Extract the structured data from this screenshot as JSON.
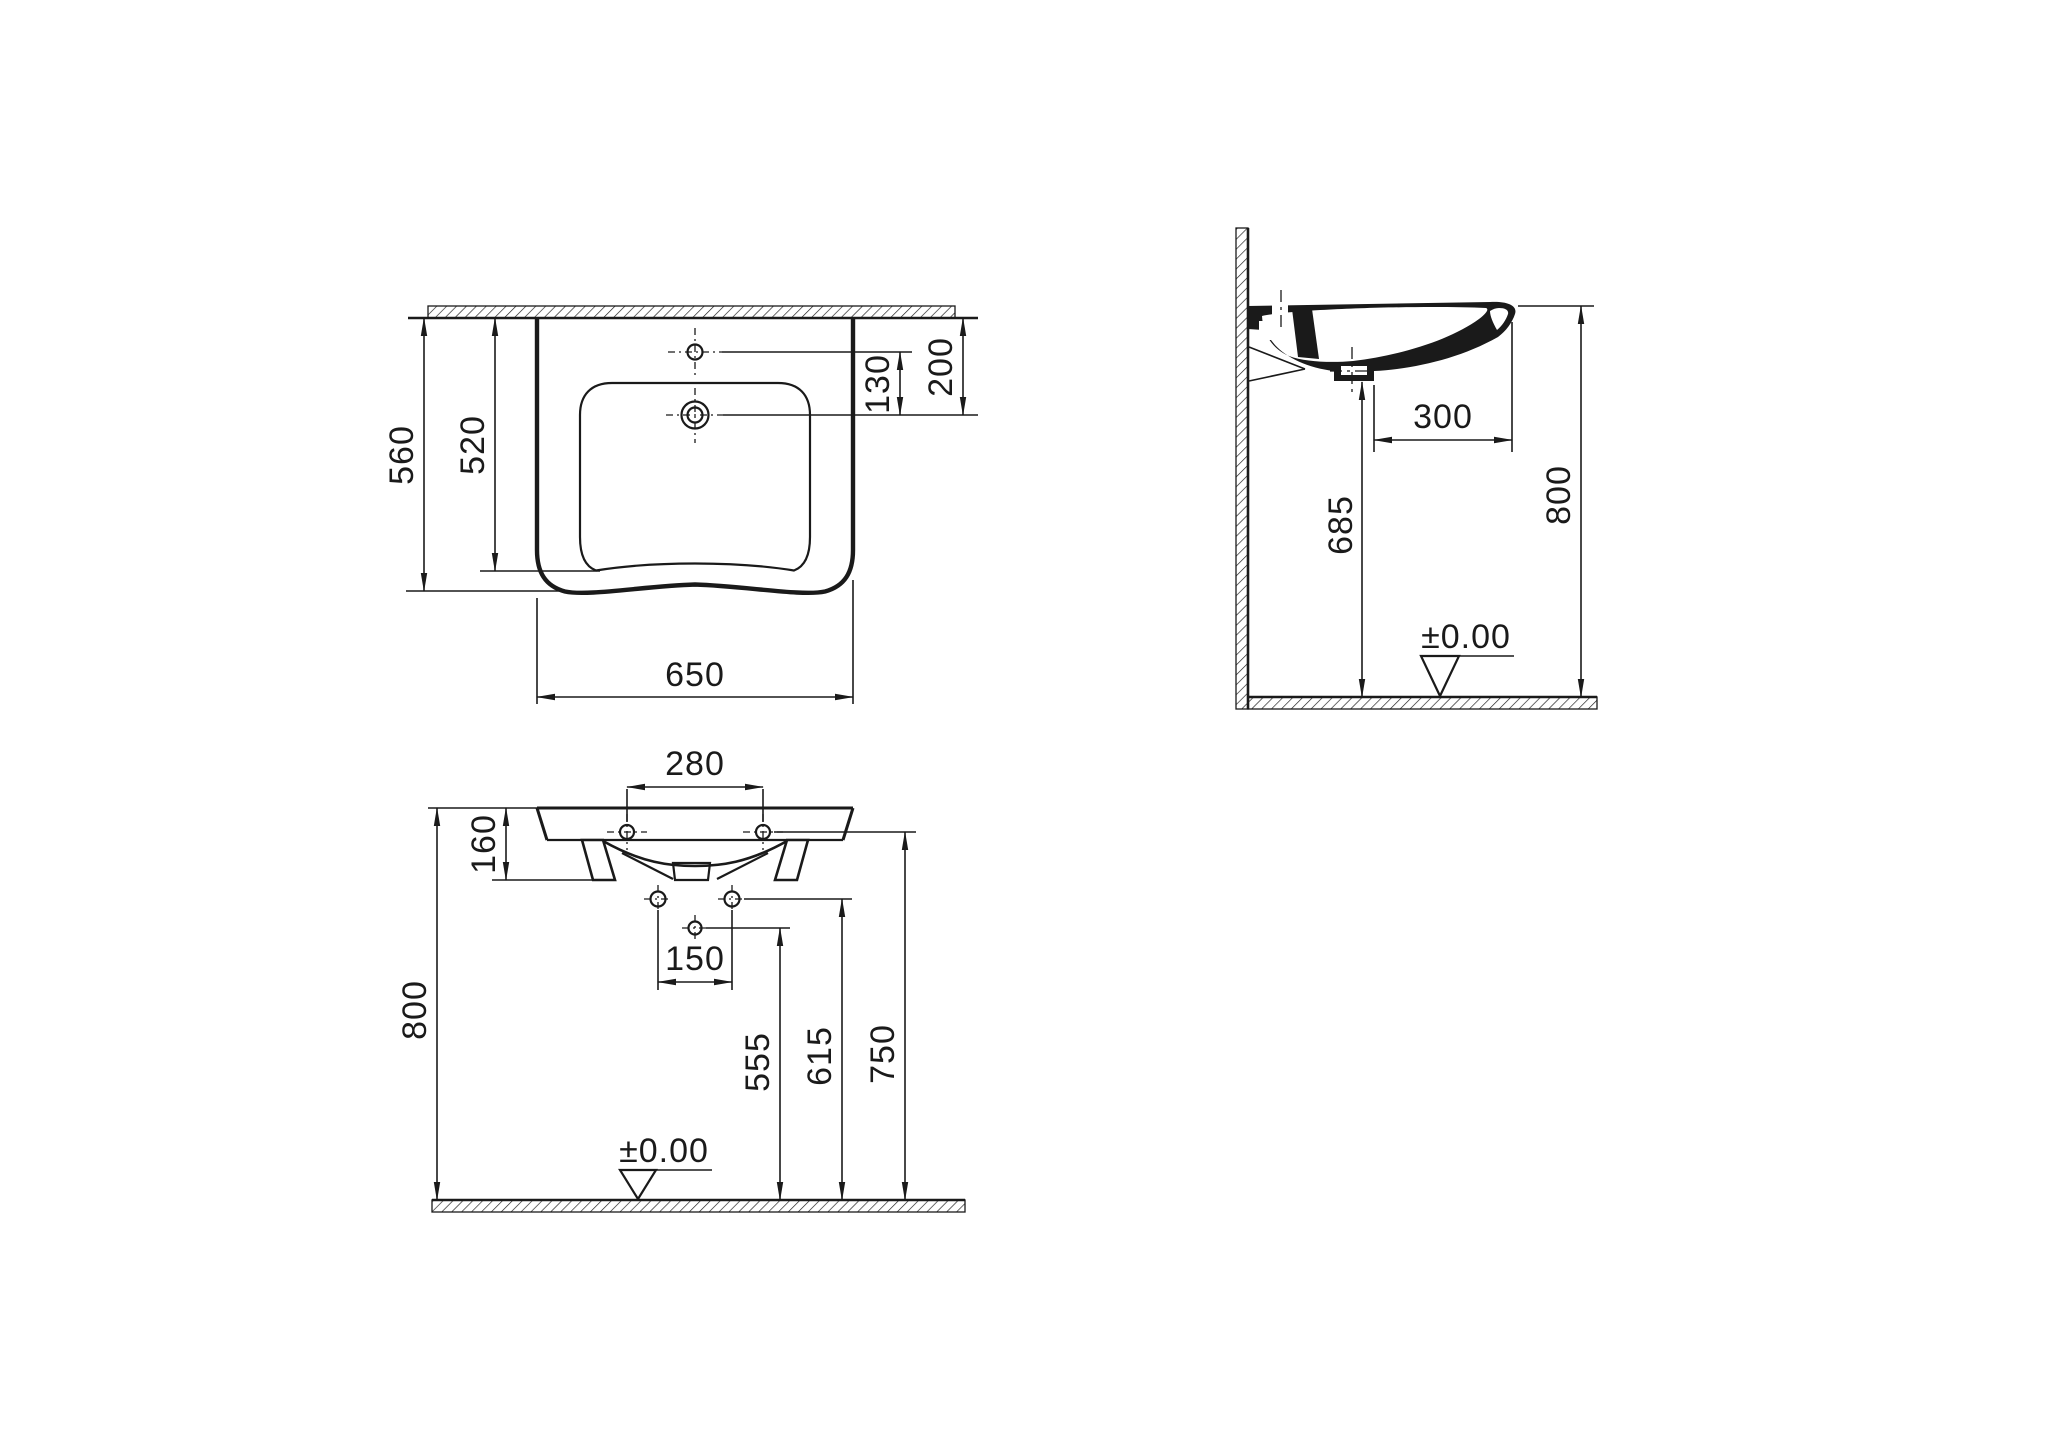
{
  "colors": {
    "ink": "#1a1a1a",
    "paper": "#ffffff"
  },
  "plan_view": {
    "overall_depth": "560",
    "basin_depth": "520",
    "tap_to_drain": "130",
    "wall_to_drain": "200",
    "overall_width": "650"
  },
  "side_view": {
    "drain_to_front": "300",
    "underside_clearance": "685",
    "rim_height": "800",
    "floor_datum": "±0.00"
  },
  "front_view": {
    "tap_hole_spacing": "280",
    "body_height": "160",
    "rim_height": "800",
    "fixing_hole_spacing": "150",
    "trap_hole_height": "555",
    "fixing_hole_height": "615",
    "tap_hole_height": "750",
    "floor_datum": "±0.00"
  }
}
